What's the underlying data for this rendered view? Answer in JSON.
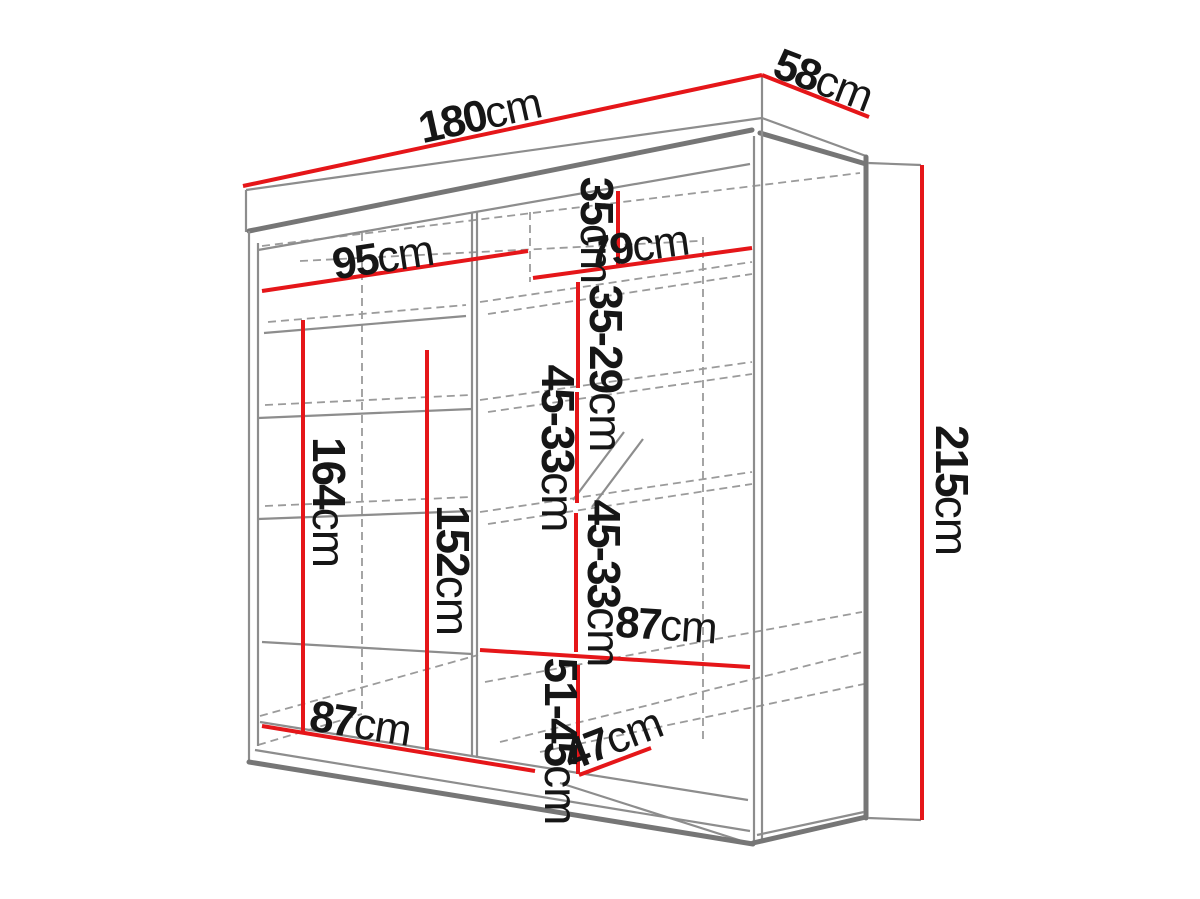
{
  "diagram": {
    "colors": {
      "dimension_line": "#e51619",
      "outline": "#8d8d8d",
      "text": "#161616",
      "background": "#ffffff"
    },
    "dims": {
      "width": {
        "value": "180",
        "unit": "cm"
      },
      "depth": {
        "value": "58",
        "unit": "cm"
      },
      "height": {
        "value": "215",
        "unit": "cm"
      },
      "top_shelf_left_width": {
        "value": "95",
        "unit": "cm"
      },
      "top_shelf_right_width": {
        "value": "79",
        "unit": "cm"
      },
      "top_section_height": {
        "value": "35",
        "unit": "cm"
      },
      "upper_shelf_spacing": {
        "value": "35-29",
        "unit": "cm"
      },
      "middle_shelf_spacing_1": {
        "value": "45-33",
        "unit": "cm"
      },
      "middle_shelf_spacing_2": {
        "value": "45-33",
        "unit": "cm"
      },
      "left_hanging_height": {
        "value": "164",
        "unit": "cm"
      },
      "center_hanging_height": {
        "value": "152",
        "unit": "cm"
      },
      "right_shelf_width": {
        "value": "87",
        "unit": "cm"
      },
      "lower_section_height": {
        "value": "51-45",
        "unit": "cm"
      },
      "bottom_shelf_depth": {
        "value": "47",
        "unit": "cm"
      },
      "left_bottom_width": {
        "value": "87",
        "unit": "cm"
      }
    }
  }
}
